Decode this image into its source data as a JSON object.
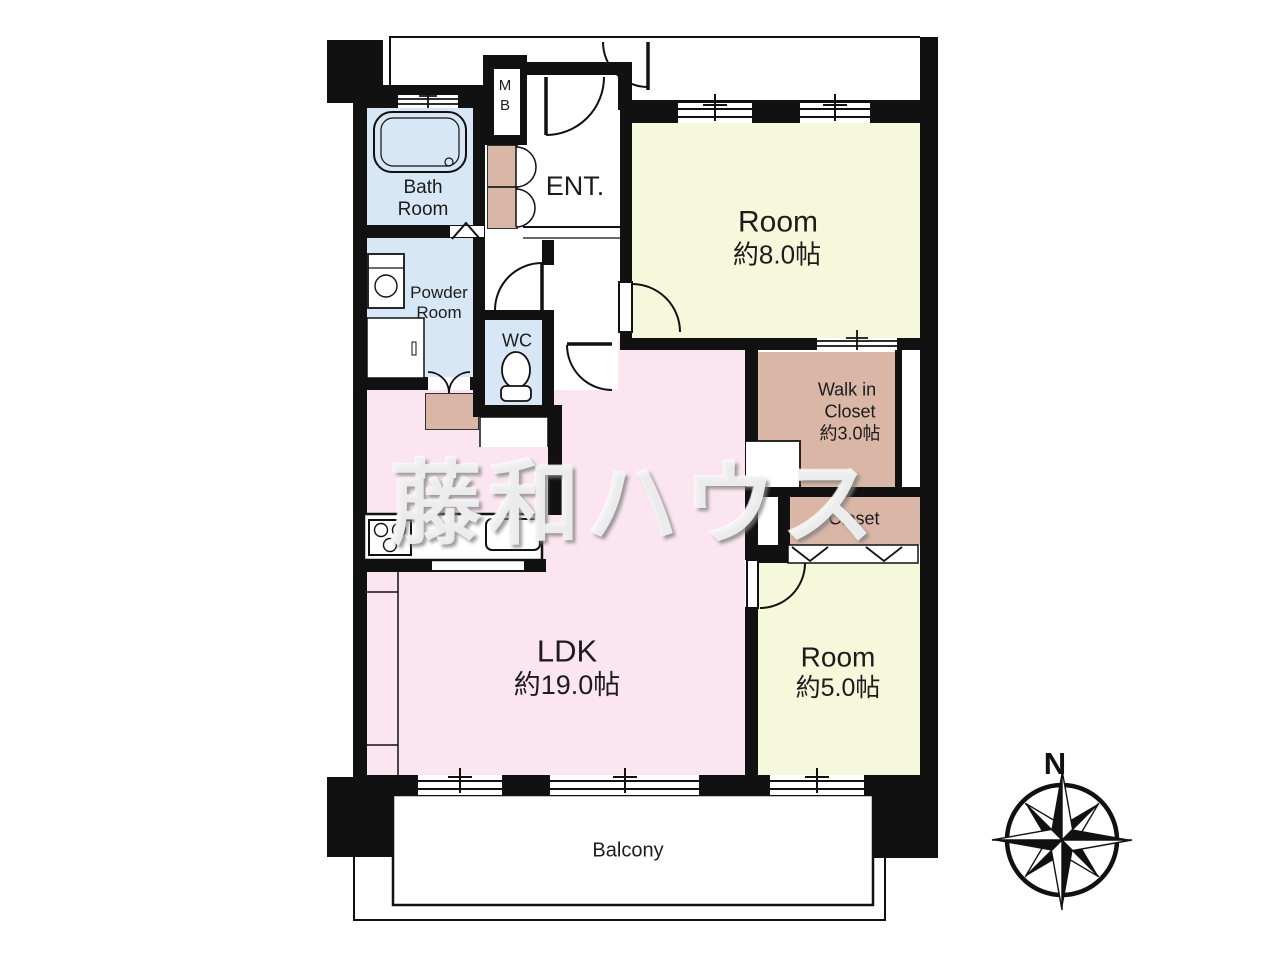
{
  "floor_plan": {
    "rooms": {
      "bath": {
        "label_line1": "Bath",
        "label_line2": "Room"
      },
      "powder": {
        "label_line1": "Powder",
        "label_line2": "Room"
      },
      "wc": {
        "label": "WC"
      },
      "meter_box": {
        "label_line1": "M",
        "label_line2": "B"
      },
      "entrance": {
        "label": "ENT."
      },
      "room_8": {
        "label": "Room",
        "size": "約8.0帖"
      },
      "walk_in_closet": {
        "label_line1": "Walk in",
        "label_line2": "Closet",
        "size": "約3.0帖"
      },
      "closet": {
        "label": "Closet"
      },
      "room_5": {
        "label": "Room",
        "size": "約5.0帖"
      },
      "ldk": {
        "label": "LDK",
        "size": "約19.0帖"
      },
      "balcony": {
        "label": "Balcony"
      }
    },
    "compass": {
      "north_label": "N"
    },
    "watermark": {
      "text": "藤和ハウス"
    },
    "colors": {
      "wall": "#111111",
      "room_yellow": "#f6f8dc",
      "ldk_pink": "#fbe5f0",
      "wet_area_blue": "#d7e7f5",
      "closet_tan": "#d9b6a6",
      "watermark_gray": "#ececec"
    }
  }
}
